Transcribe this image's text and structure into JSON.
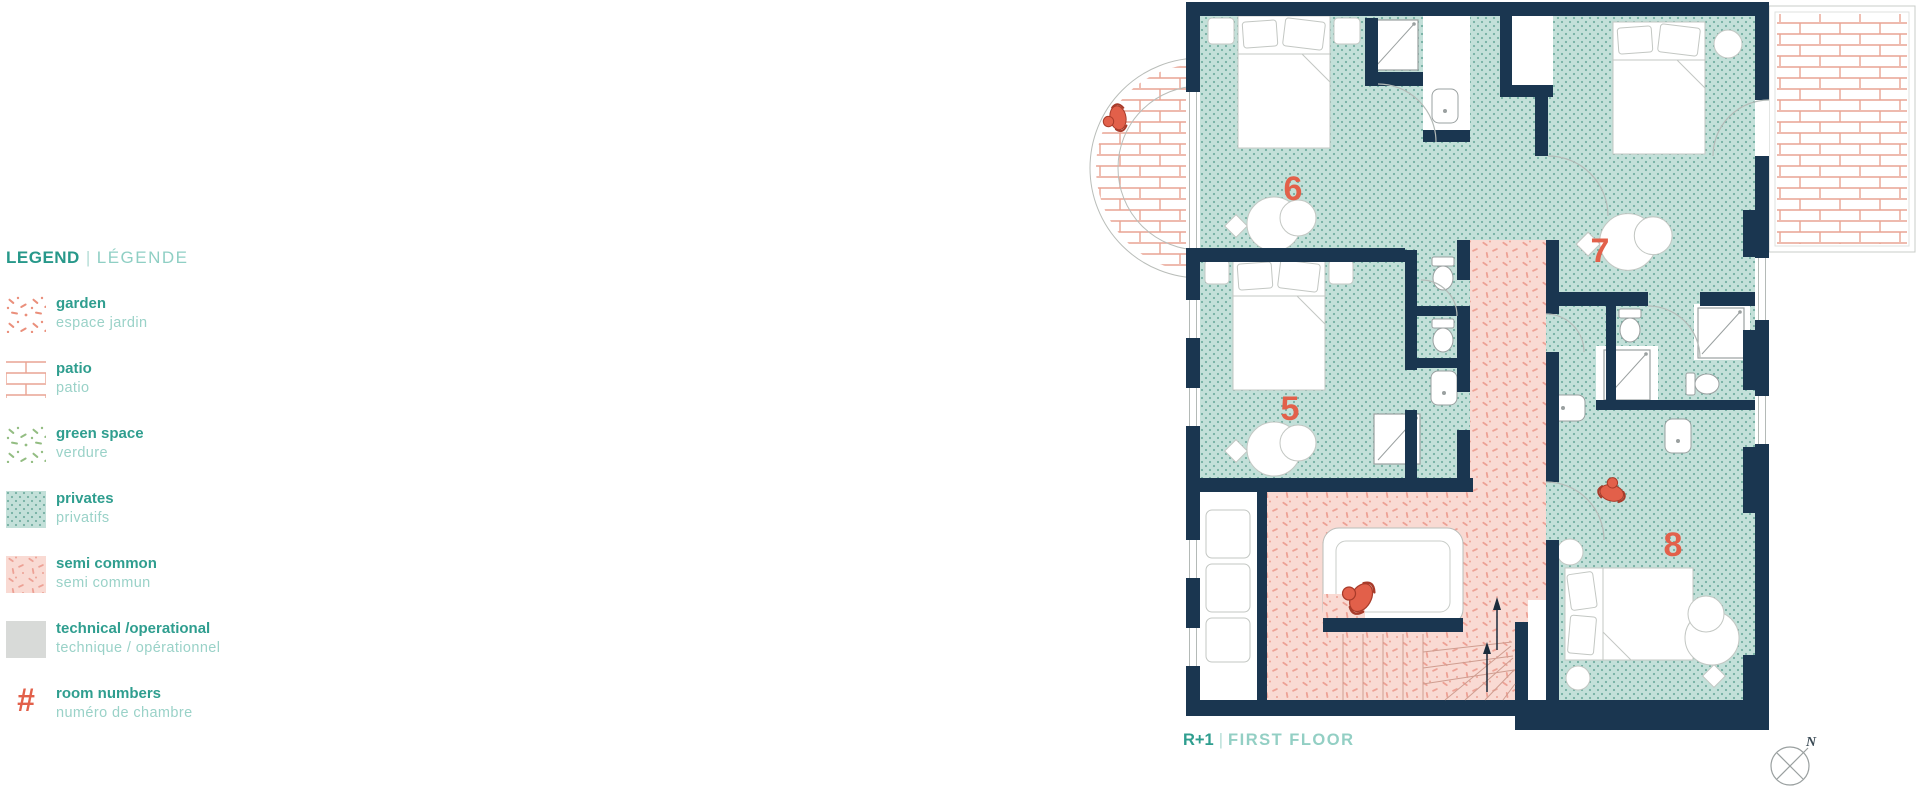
{
  "legend": {
    "title_en": "LEGEND",
    "title_sep": "|",
    "title_fr": "LÉGENDE",
    "items": [
      {
        "en": "garden",
        "fr": "espace jardin"
      },
      {
        "en": "patio",
        "fr": "patio"
      },
      {
        "en": "green space",
        "fr": "verdure"
      },
      {
        "en": "privates",
        "fr": "privatifs"
      },
      {
        "en": "semi common",
        "fr": "semi commun"
      },
      {
        "en": "technical /operational",
        "fr": "technique / opérationnel"
      },
      {
        "en": "room numbers",
        "fr": "numéro de chambre",
        "symbol": "#"
      }
    ]
  },
  "plan": {
    "caption_level": "R+1",
    "caption_sep": "|",
    "caption_name": "FIRST FLOOR",
    "rooms": [
      {
        "number": "5"
      },
      {
        "number": "6"
      },
      {
        "number": "7"
      },
      {
        "number": "8"
      }
    ],
    "compass_label": "N"
  },
  "colors": {
    "wall_navy": "#1a3650",
    "private_teal": "#c3e0d9",
    "private_dot": "#74afa2",
    "semi_common_pink": "#f9dad3",
    "semi_common_speckle": "#eda195",
    "brick_red": "#e9a493",
    "accent_red": "#e2604a",
    "legend_teal": "#2f9e8f",
    "legend_light_teal": "#93cfc4",
    "technical_gray": "#d8dad8"
  }
}
